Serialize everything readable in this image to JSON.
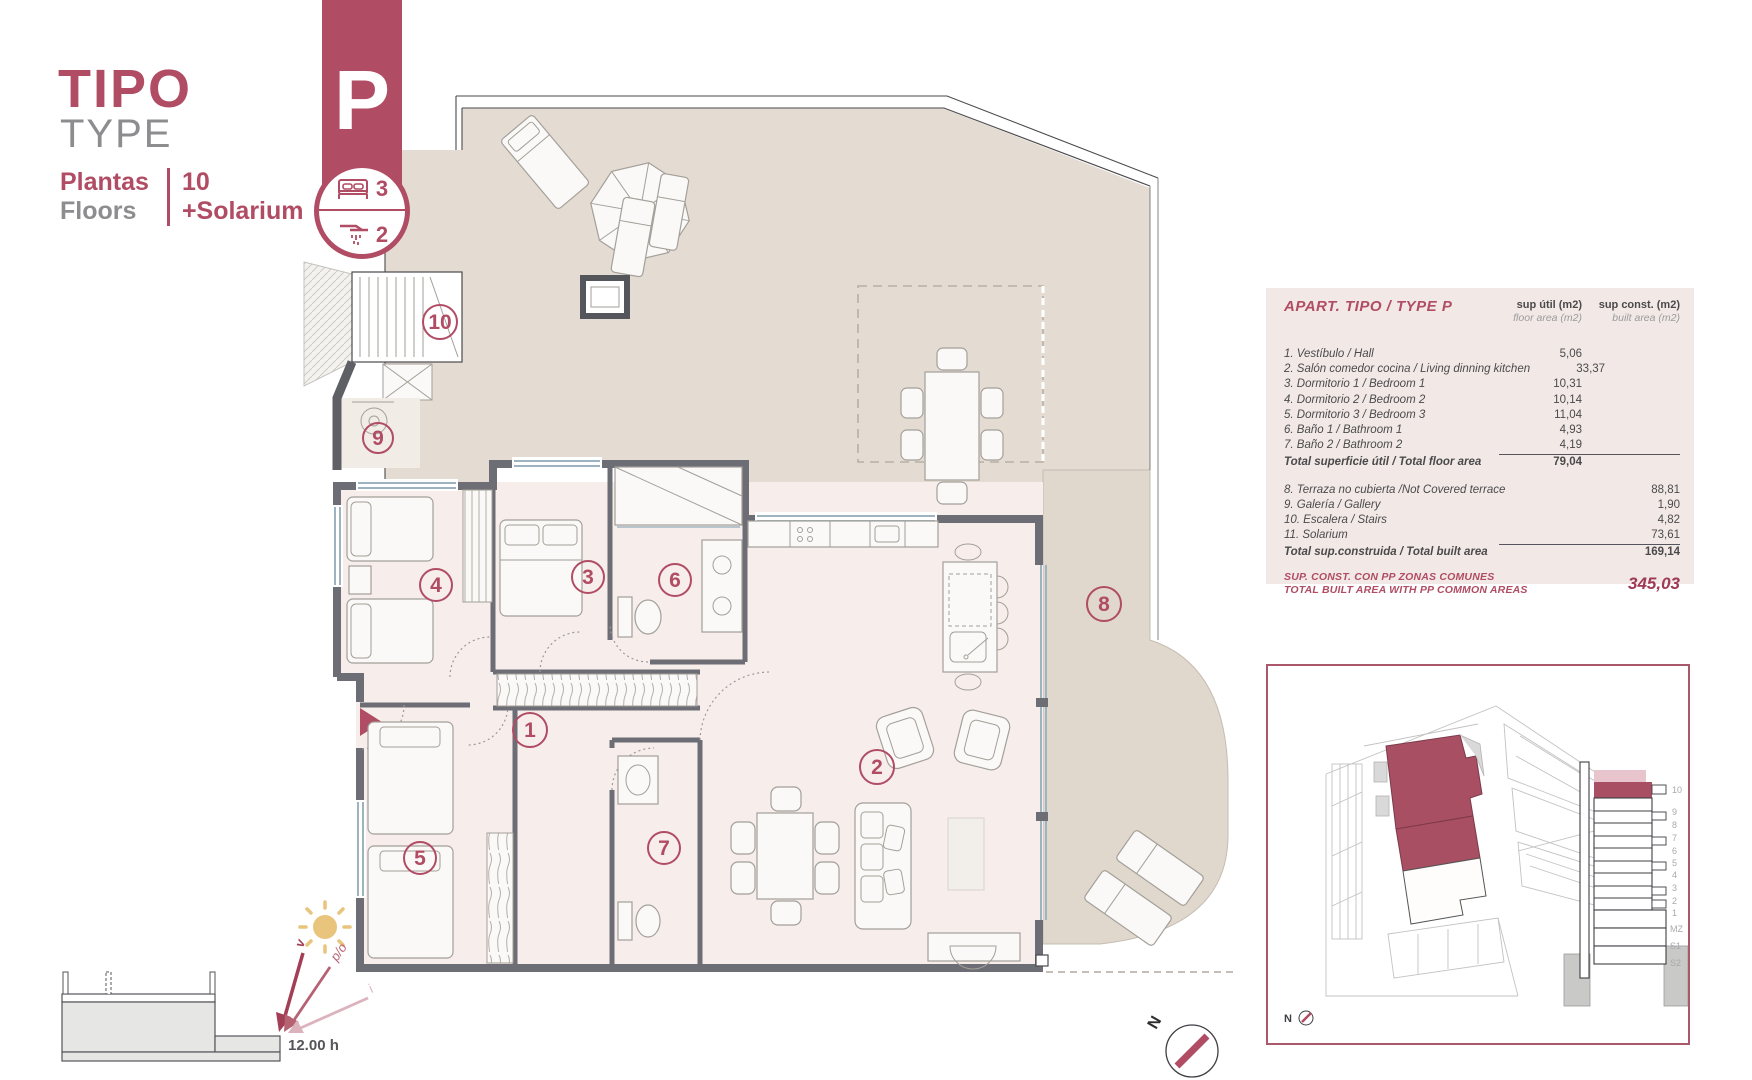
{
  "header": {
    "title_es": "TIPO",
    "title_en": "TYPE",
    "floors_label_es": "Plantas",
    "floors_label_en": "Floors",
    "floors_value": "10",
    "floors_extra": "+Solarium",
    "type_letter": "P",
    "bedrooms": "3",
    "bathrooms": "2"
  },
  "area_table": {
    "title": "APART. TIPO / TYPE P",
    "col1_title": "sup útil (m2)",
    "col1_sub": "floor area (m2)",
    "col2_title": "sup const. (m2)",
    "col2_sub": "built area (m2)",
    "floor_rows": [
      {
        "name": "1. Vestíbulo / Hall",
        "value": "5,06"
      },
      {
        "name": "2. Salón comedor cocina / Living dinning kitchen",
        "value": "33,37"
      },
      {
        "name": "3. Dormitorio 1 / Bedroom 1",
        "value": "10,31"
      },
      {
        "name": "4. Dormitorio 2 / Bedroom 2",
        "value": "10,14"
      },
      {
        "name": "5. Dormitorio 3 / Bedroom 3",
        "value": "11,04"
      },
      {
        "name": "6. Baño 1 / Bathroom 1",
        "value": "4,93"
      },
      {
        "name": "7. Baño 2 / Bathroom 2",
        "value": "4,19"
      }
    ],
    "floor_total": {
      "name": "Total superficie útil / Total floor area",
      "value": "79,04"
    },
    "built_rows": [
      {
        "name": "8. Terraza no cubierta /Not Covered terrace",
        "value": "88,81"
      },
      {
        "name": "9. Galería / Gallery",
        "value": "1,90"
      },
      {
        "name": "10. Escalera / Stairs",
        "value": "4,82"
      },
      {
        "name": "11. Solarium",
        "value": "73,61"
      }
    ],
    "built_total": {
      "name": "Total sup.construida / Total built area",
      "value": "169,14"
    },
    "summary_line1": "SUP. CONST. CON PP ZONAS COMUNES",
    "summary_line2": "TOTAL BUILT AREA WITH PP COMMON AREAS",
    "summary_value": "345,03"
  },
  "plan": {
    "rooms": [
      "1",
      "2",
      "3",
      "4",
      "5",
      "6",
      "7",
      "8",
      "9",
      "10"
    ]
  },
  "sun_diagram": {
    "label_v": "v",
    "label_po": "p/o",
    "label_i": "i",
    "time": "12.00 h"
  },
  "compass": {
    "north": "N"
  },
  "site_plan": {
    "north": "N",
    "floors": [
      "10",
      "9",
      "8",
      "7",
      "6",
      "5",
      "4",
      "3",
      "2",
      "1",
      "MZ",
      "S1",
      "S2"
    ]
  },
  "colors": {
    "brand": "#b04c63",
    "wall": "#6d6d75",
    "terrace": "#e4dcd3",
    "interior": "#f7eeec",
    "panel": "#f2e9e6",
    "highlight": "#a84f63",
    "sun": "#e8c47c"
  }
}
